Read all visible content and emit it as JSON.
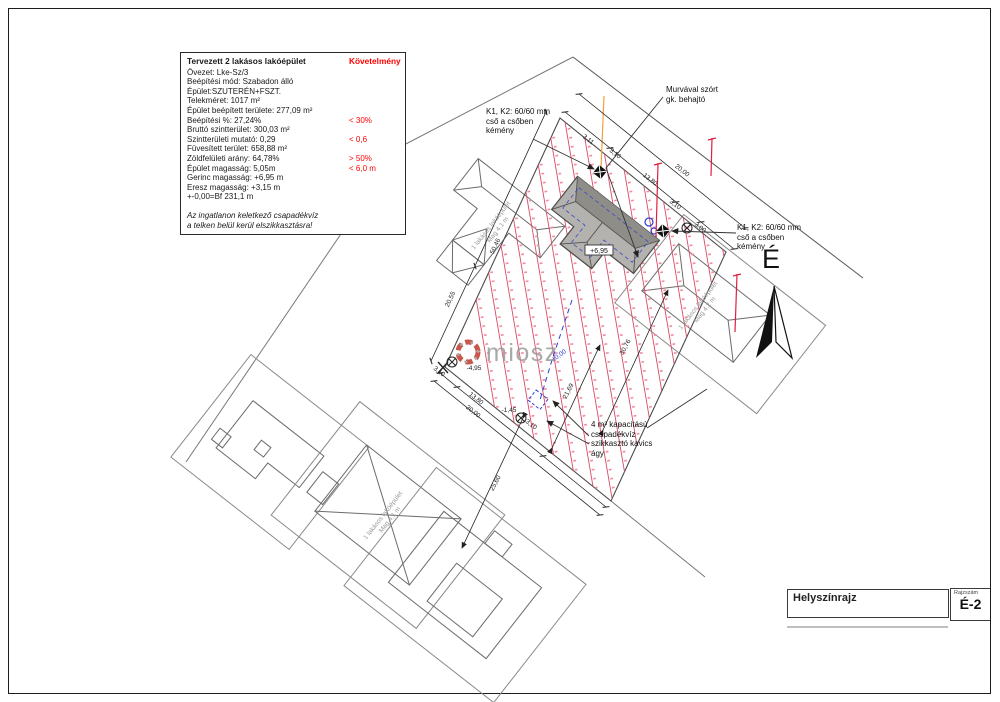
{
  "colors": {
    "requirement_red": "#ff0000",
    "contour_red": "#d84a66",
    "hatch_pink": "#f28aa2",
    "level_blue": "#2a3fd4",
    "stake_red": "#e02040",
    "boundary_grey": "#6f6f6f",
    "building_grey": "#b4b2ae"
  },
  "infobox": {
    "title": "Tervezett 2 lakásos lakóépület",
    "req_header": "Követelmény",
    "rows": [
      {
        "label": "Övezet: Lke-Sz/3"
      },
      {
        "label": "Beépítési mód: Szabadon álló"
      },
      {
        "label": "Épület:SZUTERÉN+FSZT."
      },
      {
        "label": "Telekméret: 1017 m²"
      },
      {
        "label": "Épület beépített területe: 277,09 m²"
      },
      {
        "label": "Beépítési %: 27,24%",
        "req": "< 30%"
      },
      {
        "label": "Bruttó szintterület: 300,03 m²"
      },
      {
        "label": "Szintterületi mutató: 0,29",
        "req": "< 0,6"
      },
      {
        "label": "Füvesített terület: 658,88 m²"
      },
      {
        "label": "Zöldfelületi arány: 64,78%",
        "req": "> 50%"
      },
      {
        "label": "Épület magasság: 5,05m",
        "req": "< 6,0 m"
      },
      {
        "label": "Gerinc magasság: +6,95 m"
      },
      {
        "label": "Eresz magasság: +3,15 m"
      },
      {
        "label": "+-0,00=Bf 231,1 m"
      }
    ],
    "note1": "Az ingatlanon keletkező csapadékvíz",
    "note2": "a telken belül kerül elszikkasztásra!"
  },
  "annotations": {
    "driveway": [
      "Murvával szórt",
      "gk. behajtó"
    ],
    "chimney_left": [
      "K1, K2: 60/60 mm",
      "cső a csőben",
      "kémény"
    ],
    "chimney_right": [
      "K1, K2: 60/60 mm",
      "cső a csőben",
      "kémény"
    ],
    "soakaway": [
      "4 m³ kapacitású",
      "csapadékvíz",
      "szikkasztó kavics",
      "ágy"
    ]
  },
  "labels": {
    "north": "É",
    "watermark": "miosz",
    "ridge_height": "+6,95"
  },
  "dims": {
    "nw_311": "3,11",
    "ne_310a": "3,10",
    "ne_1380": "13,80",
    "ne_2000": "20,00",
    "ne_310b": "3,10",
    "ne_300": "3,00",
    "nw_2055": "20,55",
    "nw_5046": "50,46",
    "sw_310a": "3,10",
    "sw_1380": "13,80",
    "sw_2000": "20,00",
    "sw_310b": "3,10",
    "s_2560": "25,60",
    "in_2169": "21,69",
    "in_3076": "30,76",
    "lv_495": "-4,95",
    "lv_145": "-1,45",
    "lv_zero": "±0,00"
  },
  "neighbors": {
    "upper_left": {
      "l1": "1 lakásos lakóépület",
      "l2": "Mag 4,1 m"
    },
    "left": {
      "l1": "1 lakásos lakóépület",
      "l2": "Mag 4,1 m"
    },
    "right": {
      "l1": "1 lakásos lakóépület",
      "l2": "Mag 4,2 m"
    }
  },
  "titleblock": {
    "title": "Helyszínrajz",
    "number_label": "Rajzszám",
    "number": "É-2"
  }
}
